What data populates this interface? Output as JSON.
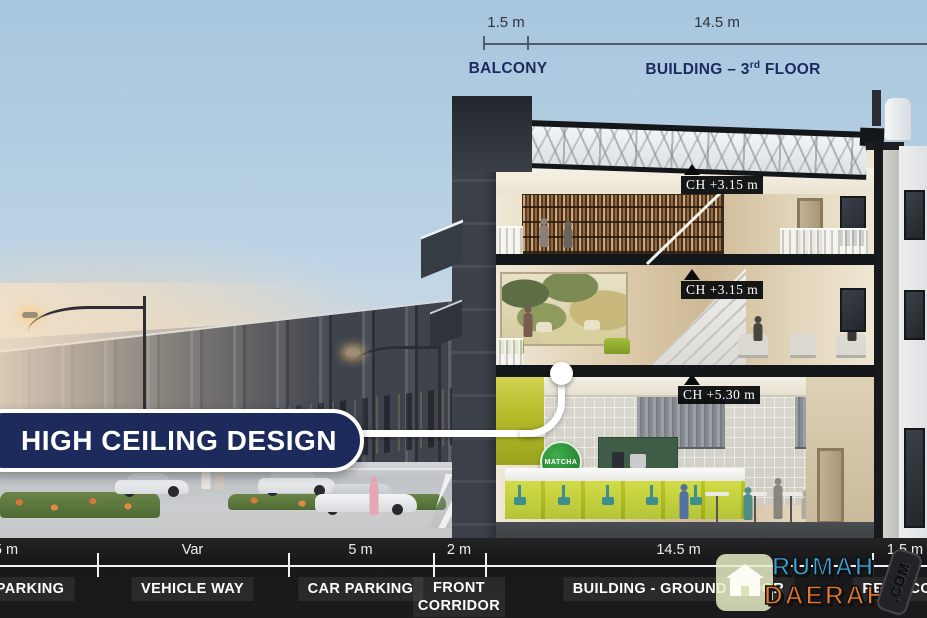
{
  "top": {
    "balcony_dim": "1.5 m",
    "balcony_label": "BALCONY",
    "building_dim": "14.5 m",
    "building_prefix": "BUILDING – 3",
    "building_sup": "rd",
    "building_suffix": " FLOOR"
  },
  "callout": {
    "label": "HIGH CEILING DESIGN"
  },
  "ch_labels": [
    {
      "text": "CH +3.15 m"
    },
    {
      "text": "CH +3.15 m"
    },
    {
      "text": "CH +5.30 m"
    }
  ],
  "scene": {
    "cafe_sign": "MATCHA"
  },
  "bottom_bar": {
    "segments": [
      {
        "dim": "5 m",
        "label": "PARKING"
      },
      {
        "dim": "Var",
        "label": "VEHICLE WAY"
      },
      {
        "dim": "5 m",
        "label": "CAR PARKING"
      },
      {
        "dim": "2 m",
        "label": "FRONT CORRIDOR"
      },
      {
        "dim": "14.5 m",
        "label": "BUILDING - GROUND FLOOR"
      },
      {
        "dim": "1.5 m",
        "label": "REAR CORRIDOR"
      }
    ]
  },
  "watermark": {
    "word1": "RUMAH",
    "word2": "DAERAH",
    "badge": ".COM"
  },
  "colors": {
    "navy": "#1c2a5c",
    "label_navy": "#1b2a5e",
    "lime": "#bfca2a",
    "matcha_green": "#2f9e44",
    "logo_blue": "#3b9fd8",
    "logo_orange": "#e2792e",
    "bar_black": "#1b1b1d"
  }
}
